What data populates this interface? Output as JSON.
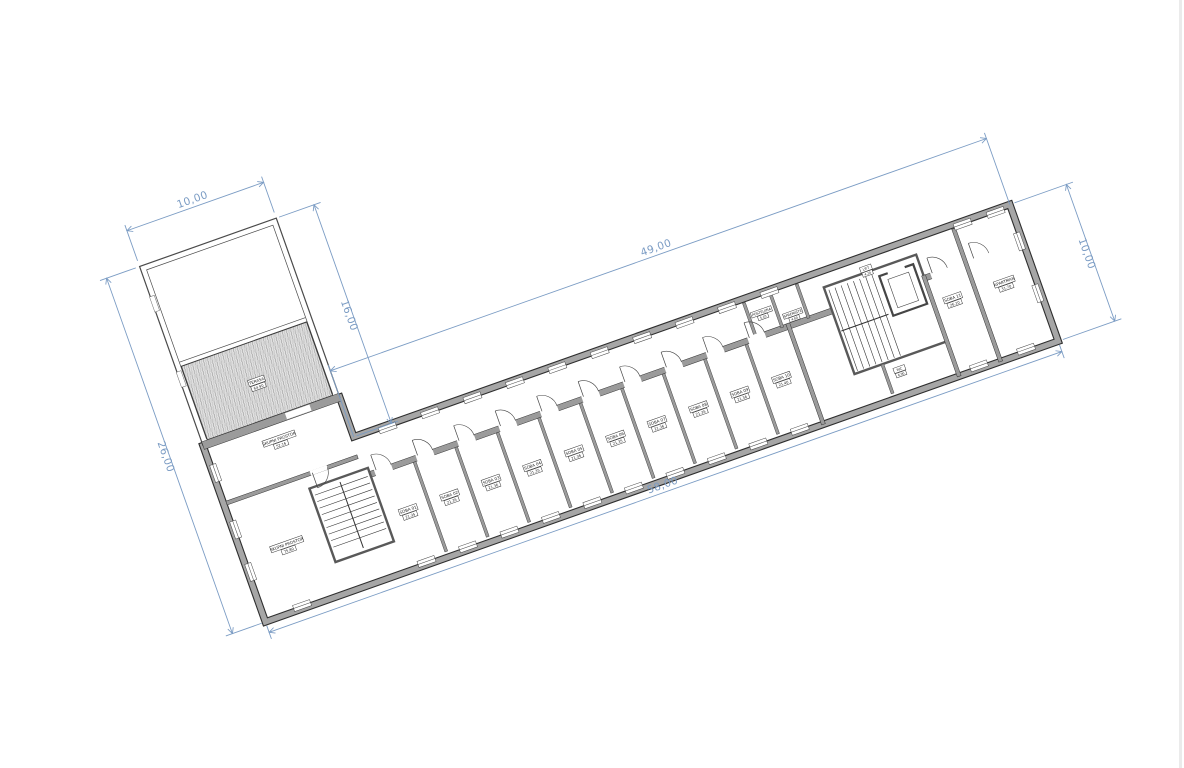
{
  "colors": {
    "dimension": "#7b9cc4",
    "wall": "#9b9b9b",
    "wall_edge": "#2e2e2e",
    "hatch_bg": "#e3e3e3",
    "hatch_line": "#909090"
  },
  "dimensions": {
    "top_left": "10,00",
    "block_right": "16,00",
    "wing_top": "49,00",
    "right_end": "10,00",
    "wing_bottom": "58,00",
    "left": "26,00"
  },
  "rooms": {
    "terrace": {
      "name": "TERASA",
      "area": "64.90"
    },
    "common_upper": {
      "name": "SKUPNI PROSTOR",
      "area": "52.16"
    },
    "common_lower": {
      "name": "SKUPNI PROSTOR",
      "area": "75.80"
    },
    "row": [
      {
        "name": "SOBA 01",
        "area": "21.35"
      },
      {
        "name": "SOBA 02",
        "area": "21.35"
      },
      {
        "name": "SOBA 03",
        "area": "21.36"
      },
      {
        "name": "SOBA 04",
        "area": "21.35"
      },
      {
        "name": "SOBA 05",
        "area": "21.36"
      },
      {
        "name": "SOBA 06",
        "area": "21.35"
      },
      {
        "name": "SOBA 07",
        "area": "21.36"
      },
      {
        "name": "SOBA 08",
        "area": "21.35"
      },
      {
        "name": "SOBA 09",
        "area": "21.36"
      },
      {
        "name": "SOBA 10",
        "area": "21.40"
      }
    ],
    "linen": {
      "name": "POSTELJINA",
      "area": "5.10"
    },
    "storage": {
      "name": "SPREMIŠTE",
      "area": "4.80"
    },
    "lift": {
      "name": "LIFT",
      "area": "4.20"
    },
    "wc": {
      "name": "WC",
      "area": "6.90"
    },
    "room_11": {
      "name": "SOBA 11",
      "area": "26.10"
    },
    "apartment": {
      "name": "APARTMAN",
      "area": "31.70"
    }
  }
}
